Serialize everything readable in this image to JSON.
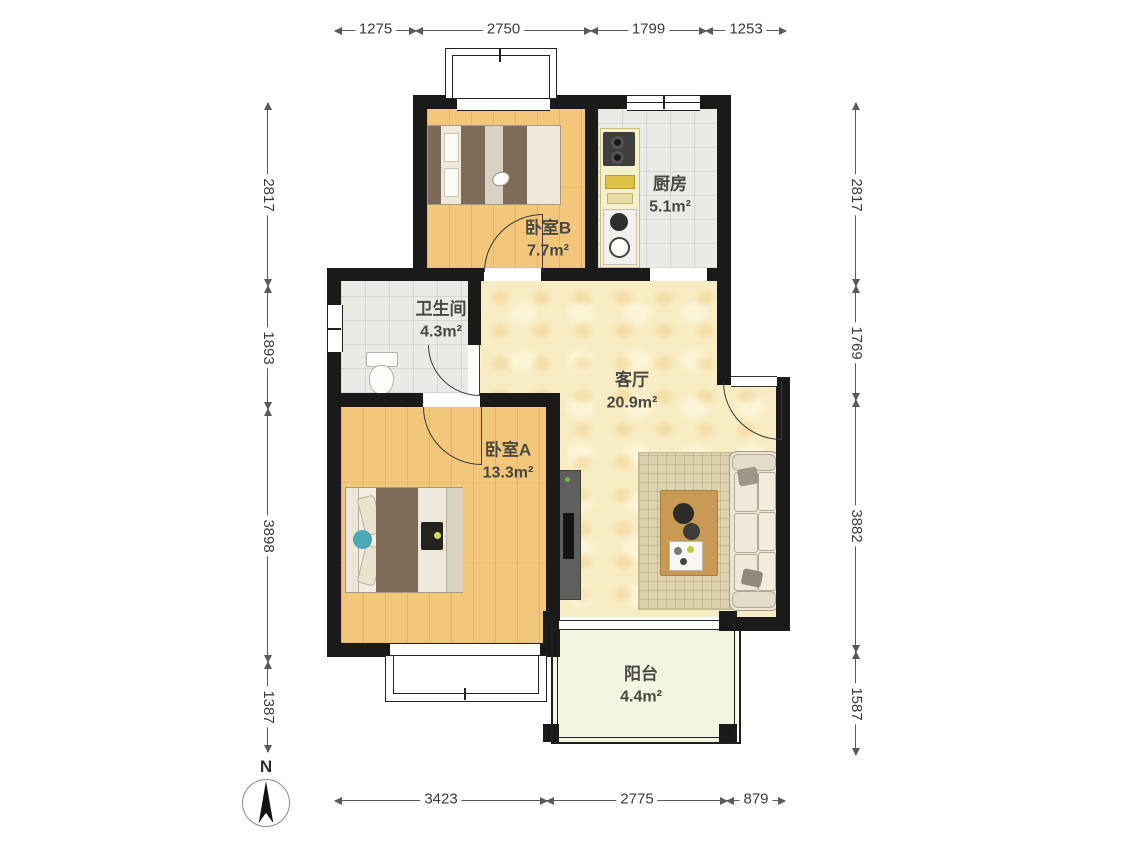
{
  "plan": {
    "type": "residential-floor-plan",
    "units": "mm"
  },
  "rooms": {
    "bedroom_b": {
      "name": "卧室B",
      "area": "7.7m²"
    },
    "kitchen": {
      "name": "厨房",
      "area": "5.1m²"
    },
    "bathroom": {
      "name": "卫生间",
      "area": "4.3m²"
    },
    "living": {
      "name": "客厅",
      "area": "20.9m²"
    },
    "bedroom_a": {
      "name": "卧室A",
      "area": "13.3m²"
    },
    "balcony": {
      "name": "阳台",
      "area": "4.4m²"
    }
  },
  "dimensions": {
    "top": [
      "1275",
      "2750",
      "1799",
      "1253"
    ],
    "bottom": [
      "3423",
      "2775",
      "879"
    ],
    "left": [
      "2817",
      "1893",
      "3898",
      "1387"
    ],
    "right": [
      "2817",
      "1769",
      "3882",
      "1587"
    ]
  },
  "compass": {
    "north_label": "N"
  },
  "colors": {
    "wall": "#1a1a1a",
    "wood_floor": "#f2c77c",
    "living_floor": "#f8ecc3",
    "tile_floor": "#ebebe6",
    "balcony_floor": "#f4f5e1",
    "dimension_text": "#3a3a3a",
    "label_text": "#4b4742"
  }
}
